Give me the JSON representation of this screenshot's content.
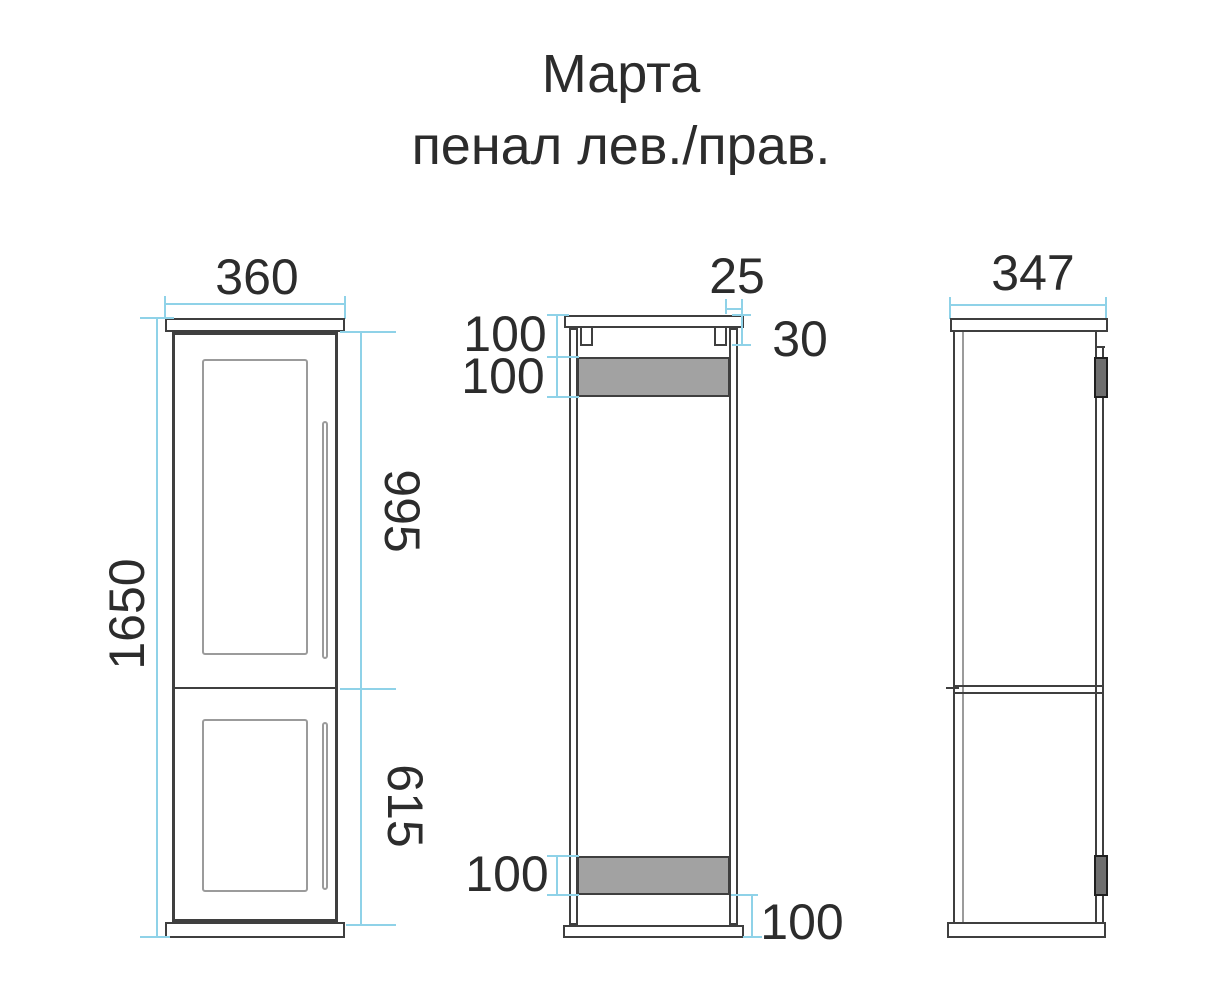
{
  "title": {
    "line1": "Марта",
    "line2": "пенал лев./прав."
  },
  "front_view": {
    "width": "360",
    "height": "1650",
    "upper_door_height": "995",
    "lower_door_height": "615"
  },
  "section_view": {
    "hanger_width": "25",
    "hanger_height": "30",
    "top_rail_offset": "100",
    "top_rail_height": "100",
    "bottom_rail_height": "100",
    "bottom_rail_offset": "100"
  },
  "side_view": {
    "depth": "347"
  },
  "colors": {
    "outline": "#3f3f3f",
    "secondary_line": "#9b9b9b",
    "dimension_line": "#8fd2e8",
    "rail_fill": "#a2a2a2",
    "hinge_fill": "#6f6f6f",
    "text": "#2c2c2c"
  }
}
